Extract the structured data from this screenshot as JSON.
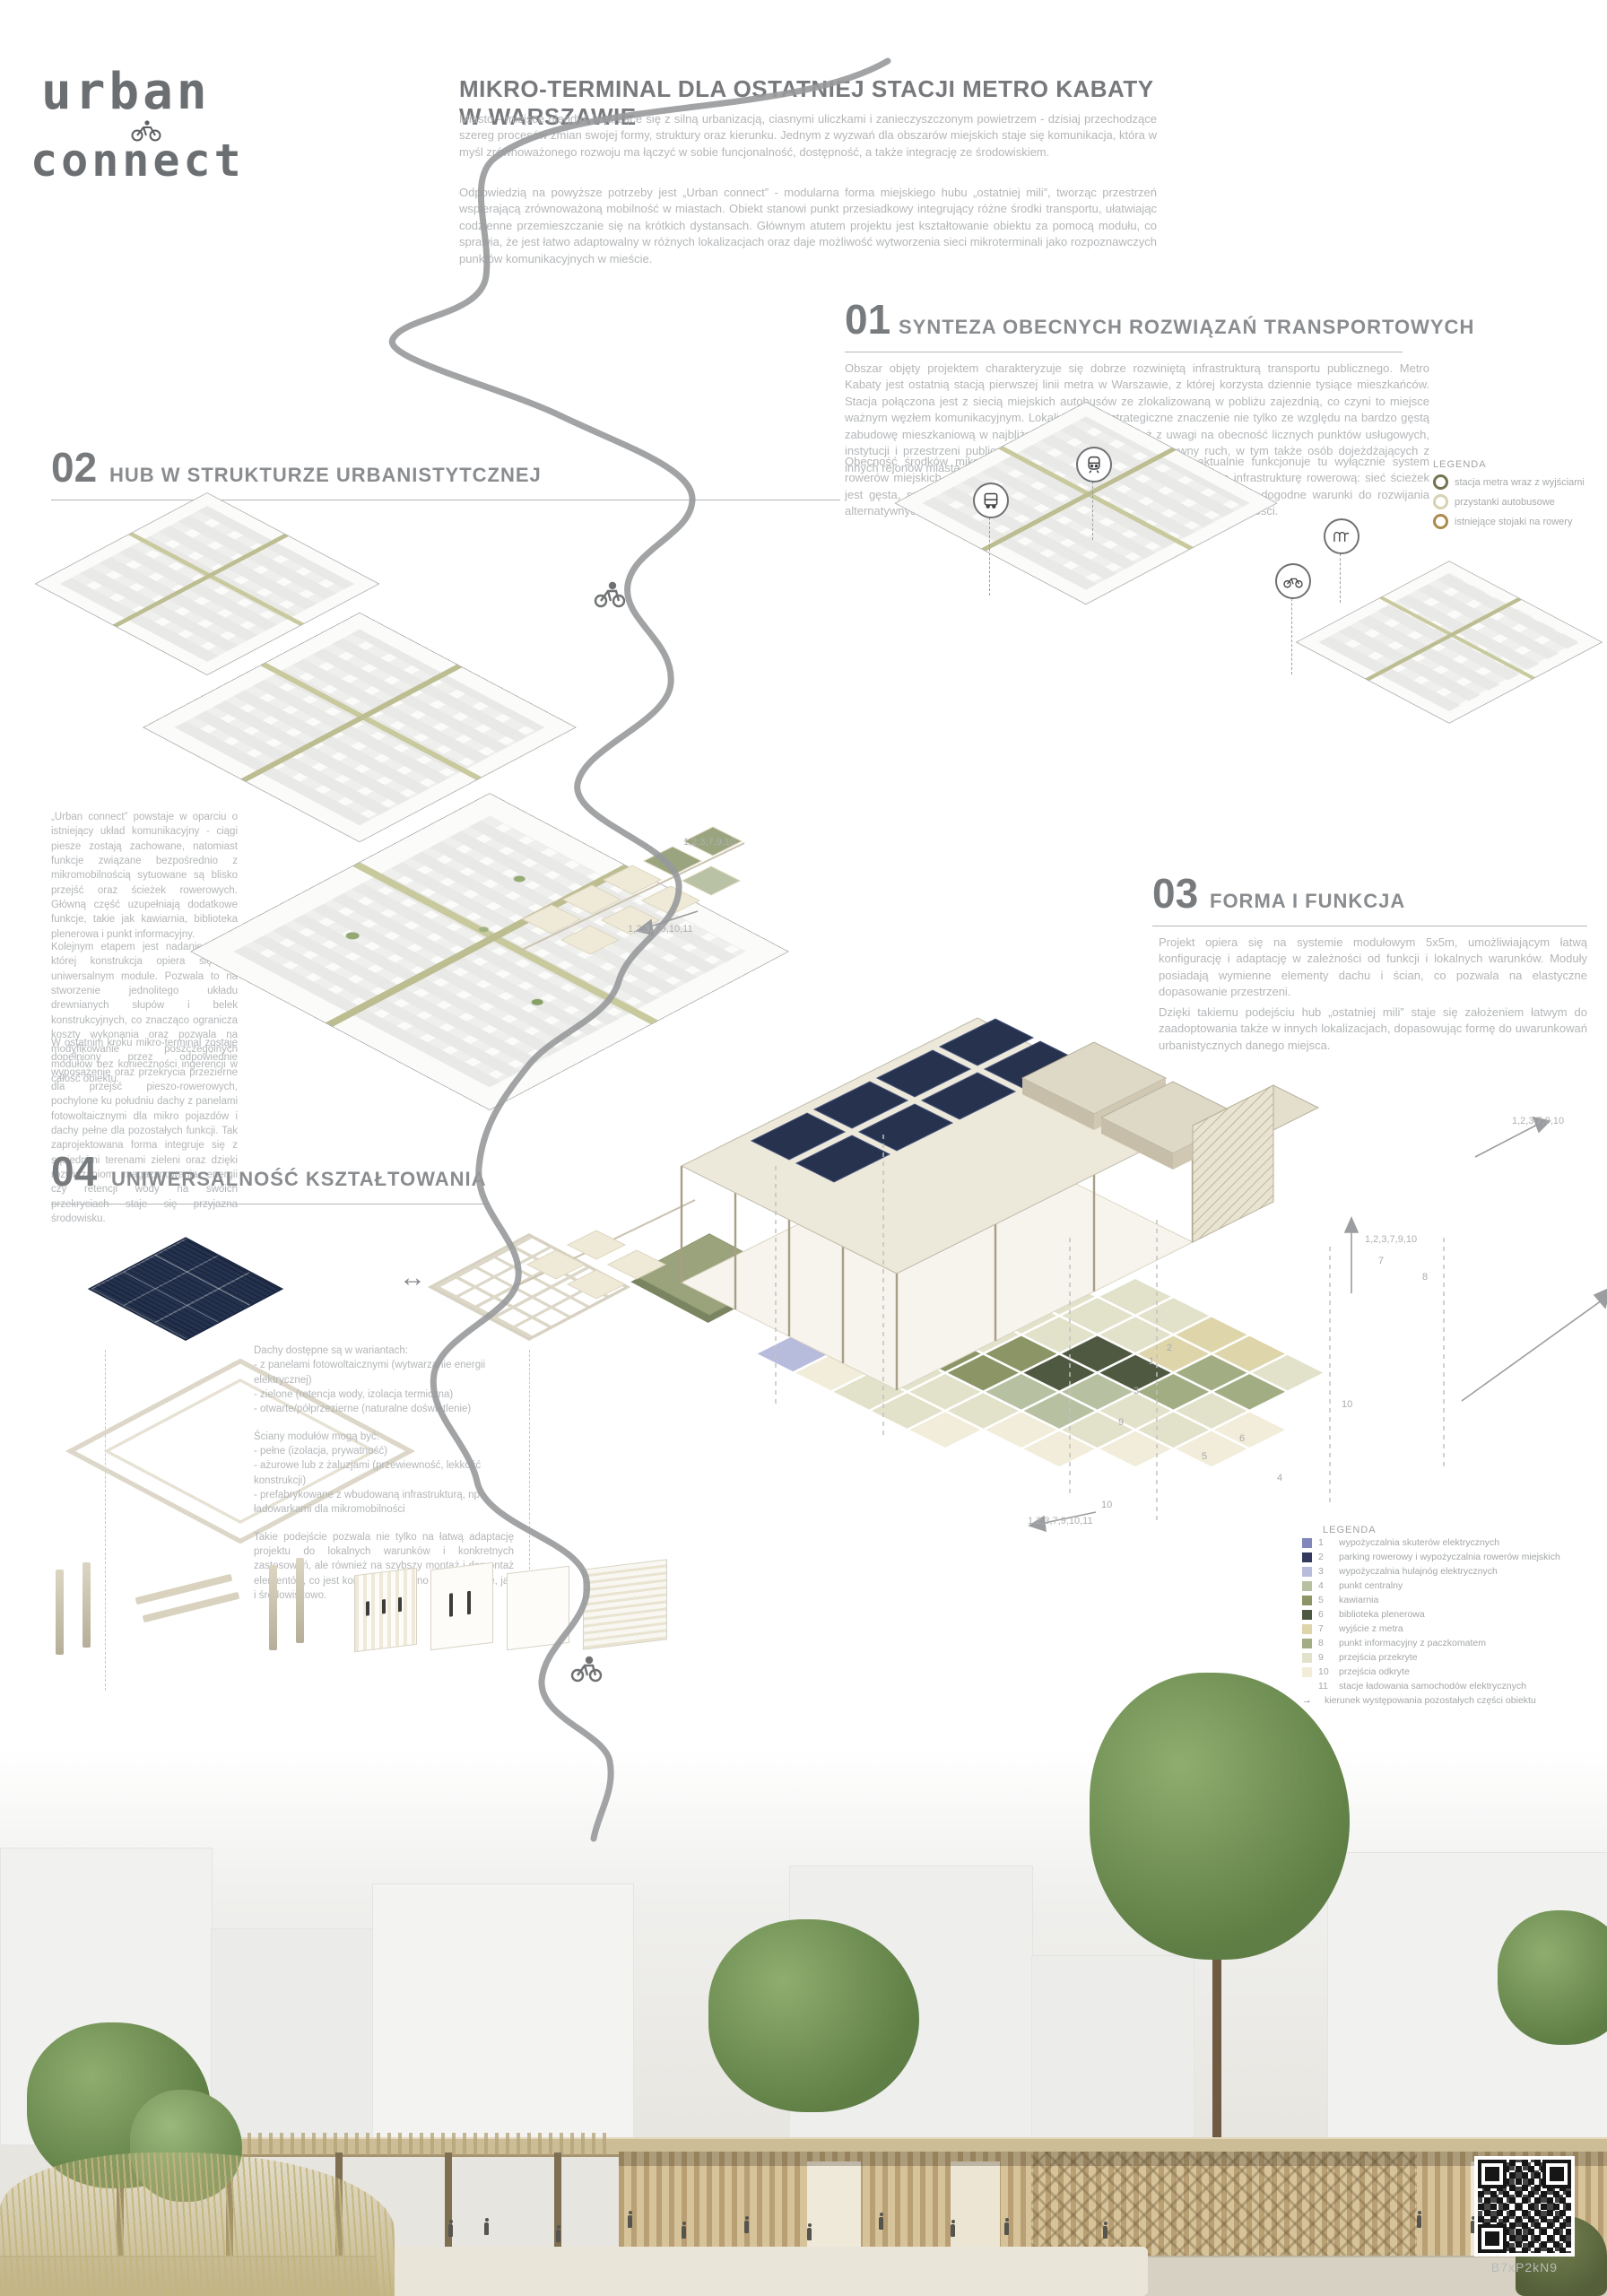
{
  "logo": {
    "line1": "urban",
    "line2": "connect"
  },
  "header": {
    "title": "MIKRO-TERMINAL DLA OSTATNIEJ STACJI METRO KABATY W WARSZAWIE",
    "p1": "Miasto - miejsce niegdyś kojarzące się z silną urbanizacją, ciasnymi uliczkami i zanieczyszczonym powietrzem - dzisiaj przechodzące szereg procesów zmian swojej formy, struktury oraz kierunku. Jednym z wyzwań dla obszarów miejskich staje się komunikacja, która w myśl zrównoważonego rozwoju ma łączyć w sobie funcjonalność, dostępność, a także integrację ze środowiskiem.",
    "p2": "Odpowiedzią na powyższe potrzeby jest „Urban connect” - modularna forma miejskiego hubu „ostatniej mili”, tworząc przestrzeń wspierającą zrównoważoną mobilność w miastach. Obiekt stanowi punkt przesiadkowy integrujący różne środki transportu, ułatwiając codzienne przemieszczanie się na krótkich dystansach. Głównym atutem projektu jest kształtowanie obiektu za pomocą modułu, co sprawia, że jest łatwo adaptowalny w różnych lokalizacjach oraz daje możliwość wytworzenia sieci mikroterminali jako rozpoznawczych punktów komunikacyjnych w mieście."
  },
  "s01": {
    "number": "01",
    "title": "SYNTEZA OBECNYCH ROZWIĄZAŃ TRANSPORTOWYCH",
    "p1": "Obszar objęty projektem charakteryzuje się dobrze rozwiniętą infrastrukturą transportu publicznego. Metro Kabaty jest ostatnią stacją pierwszej linii metra w Warszawie, z której korzysta dziennie tysiące mieszkańców. Stacja połączona jest z siecią miejskich autobusów ze zlokalizowaną w pobliżu zajezdnią, co czyni to miejsce ważnym węzłem komunikacyjnym. Lokalizacja ma strategiczne znaczenie nie tylko ze względu na bardzo gęstą zabudowę mieszkaniową w najbliższej okolicy, ale również z uwagi na obecność licznych punktów usługowych, instytucji i przestrzeni publicznych. Generuje to stały i intensywny ruch, w tym także osób dojeżdżających z innych rejonów miasta.",
    "p2": "Obecność środków mikromobilności jest jednak ograniczona – aktualnie funkcjonuje tu wyłącznie system rowerów miejskich. Warto podkreślić, że teren posiada już rozbudowaną infrastrukturę rowerową: sieć ścieżek jest gęsta, spójna i znajduje się w dobrym stanie technicznym, co stwarza dogodne warunki do rozwijania alternatywnych form transportu i dalszej integracji z planowanym hubem mobilności."
  },
  "s02": {
    "number": "02",
    "title": "HUB W STRUKTURZE URBANISTYTCZNEJ",
    "p1": "„Urban connect” powstaje w oparciu o istniejący układ komunikacyjny - ciągi piesze zostają zachowane, natomiast funkcje związane bezpośrednio z mikromobilnością sytuowane są blisko przejść oraz ścieżek rowerowych. Główną część uzupełniają dodatkowe funkcje, takie jak kawiarnia, biblioteka plenerowa i punkt informacyjny.",
    "p2": "Kolejnym etapem jest nadanie formy, której konstrukcja opiera się na uniwersalnym module. Pozwala to na stworzenie jednolitego układu drewnianych słupów i belek konstrukcyjnych, co znacząco ogranicza koszty wykonania oraz pozwala na modyfikowanie poszczególnych modułów bez konieczności ingerencji w całość obiektu.",
    "p3": "W ostatnim kroku mikro-terminal zostaje dopełniony przez odpowiednie wyposażenie oraz przekrycia przezierne dla przejść pieszo-rowerowych, pochylone ku południu dachy z panelami fotowoltaicznymi dla mikro pojazdów i dachy pełne dla pozostałych funkcji. Tak zaprojektowana forma integruje się z sąsiednimi terenami zieleni oraz dzięki rozwiązaniom magazynowania energii czy retencji wody na swoich przekryciach staje się przyjazna środowisku."
  },
  "s03": {
    "number": "03",
    "title": "FORMA I FUNKCJA",
    "p1": "Projekt opiera się na systemie modułowym 5x5m, umożliwiającym łatwą konfigurację i adaptację w zależności od funkcji i lokalnych warunków. Moduły posiadają wymienne elementy dachu i ścian, co pozwala na elastyczne dopasowanie przestrzeni.",
    "p2": "Dzięki takiemu podejściu hub „ostatniej mili” staje się założeniem łatwym do zaadoptowania także w innych lokalizacjach, dopasowując formę do uwarunkowań urbanistycznych danego miejsca."
  },
  "s04": {
    "number": "04",
    "title": "UNIWERSALNOŚĆ KSZTAŁTOWANIA",
    "roofs_title": "Dachy dostępne są w wariantach:",
    "roofs": [
      "- z panelami fotowoltaicznymi (wytwarzanie energii elektrycznej)",
      "- zielone (retencja wody, izolacja termiczna)",
      "- otwarte/półprzezierne (naturalne doświetlenie)"
    ],
    "walls_title": "Ściany modułów mogą być:",
    "walls": [
      "- pełne (izolacja, prywatność)",
      "- ażurowe lub z żaluzjami (przewiewność, lekkość konstrukcji)",
      "- prefabrykowane z wbudowaną infrastrukturą, np. ładowarkami dla mikromobilności"
    ],
    "summary": "Takie podejście pozwala nie tylko na łatwą adaptację projektu do lokalnych warunków i konkretnych zastosowań, ale również na szybszy montaż i demontaż elementów, co jest korzystne zarówno ekonomicznie, jak i środowiskowo."
  },
  "legend01": {
    "title": "LEGENDA",
    "items": [
      {
        "label": "stacja metra wraz z wyjściami",
        "color": "#73734f"
      },
      {
        "label": "przystanki autobusowe",
        "color": "#d8d1b2"
      },
      {
        "label": "istniejące stojaki na rowery",
        "color": "#ab8b4c"
      }
    ]
  },
  "legend03": {
    "title": "LEGENDA",
    "items": [
      {
        "num": "1",
        "label": "wypożyczalnia skuterów elektrycznych",
        "color": "#8186bb"
      },
      {
        "num": "2",
        "label": "parking rowerowy i wypożyczalnia rowerów miejskich",
        "color": "#343a5e"
      },
      {
        "num": "3",
        "label": "wypożyczalnia hulajnóg elektrycznych",
        "color": "#b8bcdc"
      },
      {
        "num": "4",
        "label": "punkt centralny",
        "color": "#b8c0a2"
      },
      {
        "num": "5",
        "label": "kawiarnia",
        "color": "#8b9566"
      },
      {
        "num": "6",
        "label": "biblioteka plenerowa",
        "color": "#4f5840"
      },
      {
        "num": "7",
        "label": "wyjście z metra",
        "color": "#ded5ab"
      },
      {
        "num": "8",
        "label": "punkt informacyjny z paczkomatem",
        "color": "#a3ad83"
      },
      {
        "num": "9",
        "label": "przejścia przekryte",
        "color": "#e2e2cb"
      },
      {
        "num": "10",
        "label": "przejścia odkryte",
        "color": "#f1edda"
      },
      {
        "num": "11",
        "label": "stacje ładowania samochodów elektrycznych",
        "color": ""
      }
    ],
    "arrow_label": "kierunek występowania pozostałych części obiektu"
  },
  "plan": {
    "grid": [
      [
        "",
        "",
        "",
        "",
        "9",
        "9",
        "7",
        "7",
        "9",
        ""
      ],
      [
        "",
        "",
        "",
        "9",
        "9",
        "9",
        "7",
        "8",
        "8",
        ""
      ],
      [
        "",
        "2",
        "2",
        "9",
        "9",
        "6",
        "6",
        "8",
        "9",
        "10"
      ],
      [
        "2",
        "2",
        "9",
        "9",
        "5",
        "6",
        "4",
        "9",
        "9",
        "10"
      ],
      [
        "1",
        "1",
        "9",
        "5",
        "5",
        "4",
        "4",
        "9",
        "10",
        ""
      ],
      [
        "3",
        "3",
        "9",
        "9",
        "9",
        "9",
        "10",
        "10",
        "",
        ""
      ],
      [
        "",
        "3",
        "10",
        "9",
        "9",
        "10",
        "",
        "",
        "",
        ""
      ]
    ]
  },
  "plan_axis_labels": [
    "1,2,3,7,9,10",
    "1,2,3,7,9,10,11",
    "1,2,3,7,9,10",
    "1,2,3,7,9,10",
    "1,2,3,7,9,10,11"
  ],
  "tile_numbers": [
    "7",
    "8",
    "1",
    "2",
    "3",
    "9",
    "5",
    "6",
    "4",
    "10",
    "10"
  ],
  "qr_label": "B7xP2kN9"
}
